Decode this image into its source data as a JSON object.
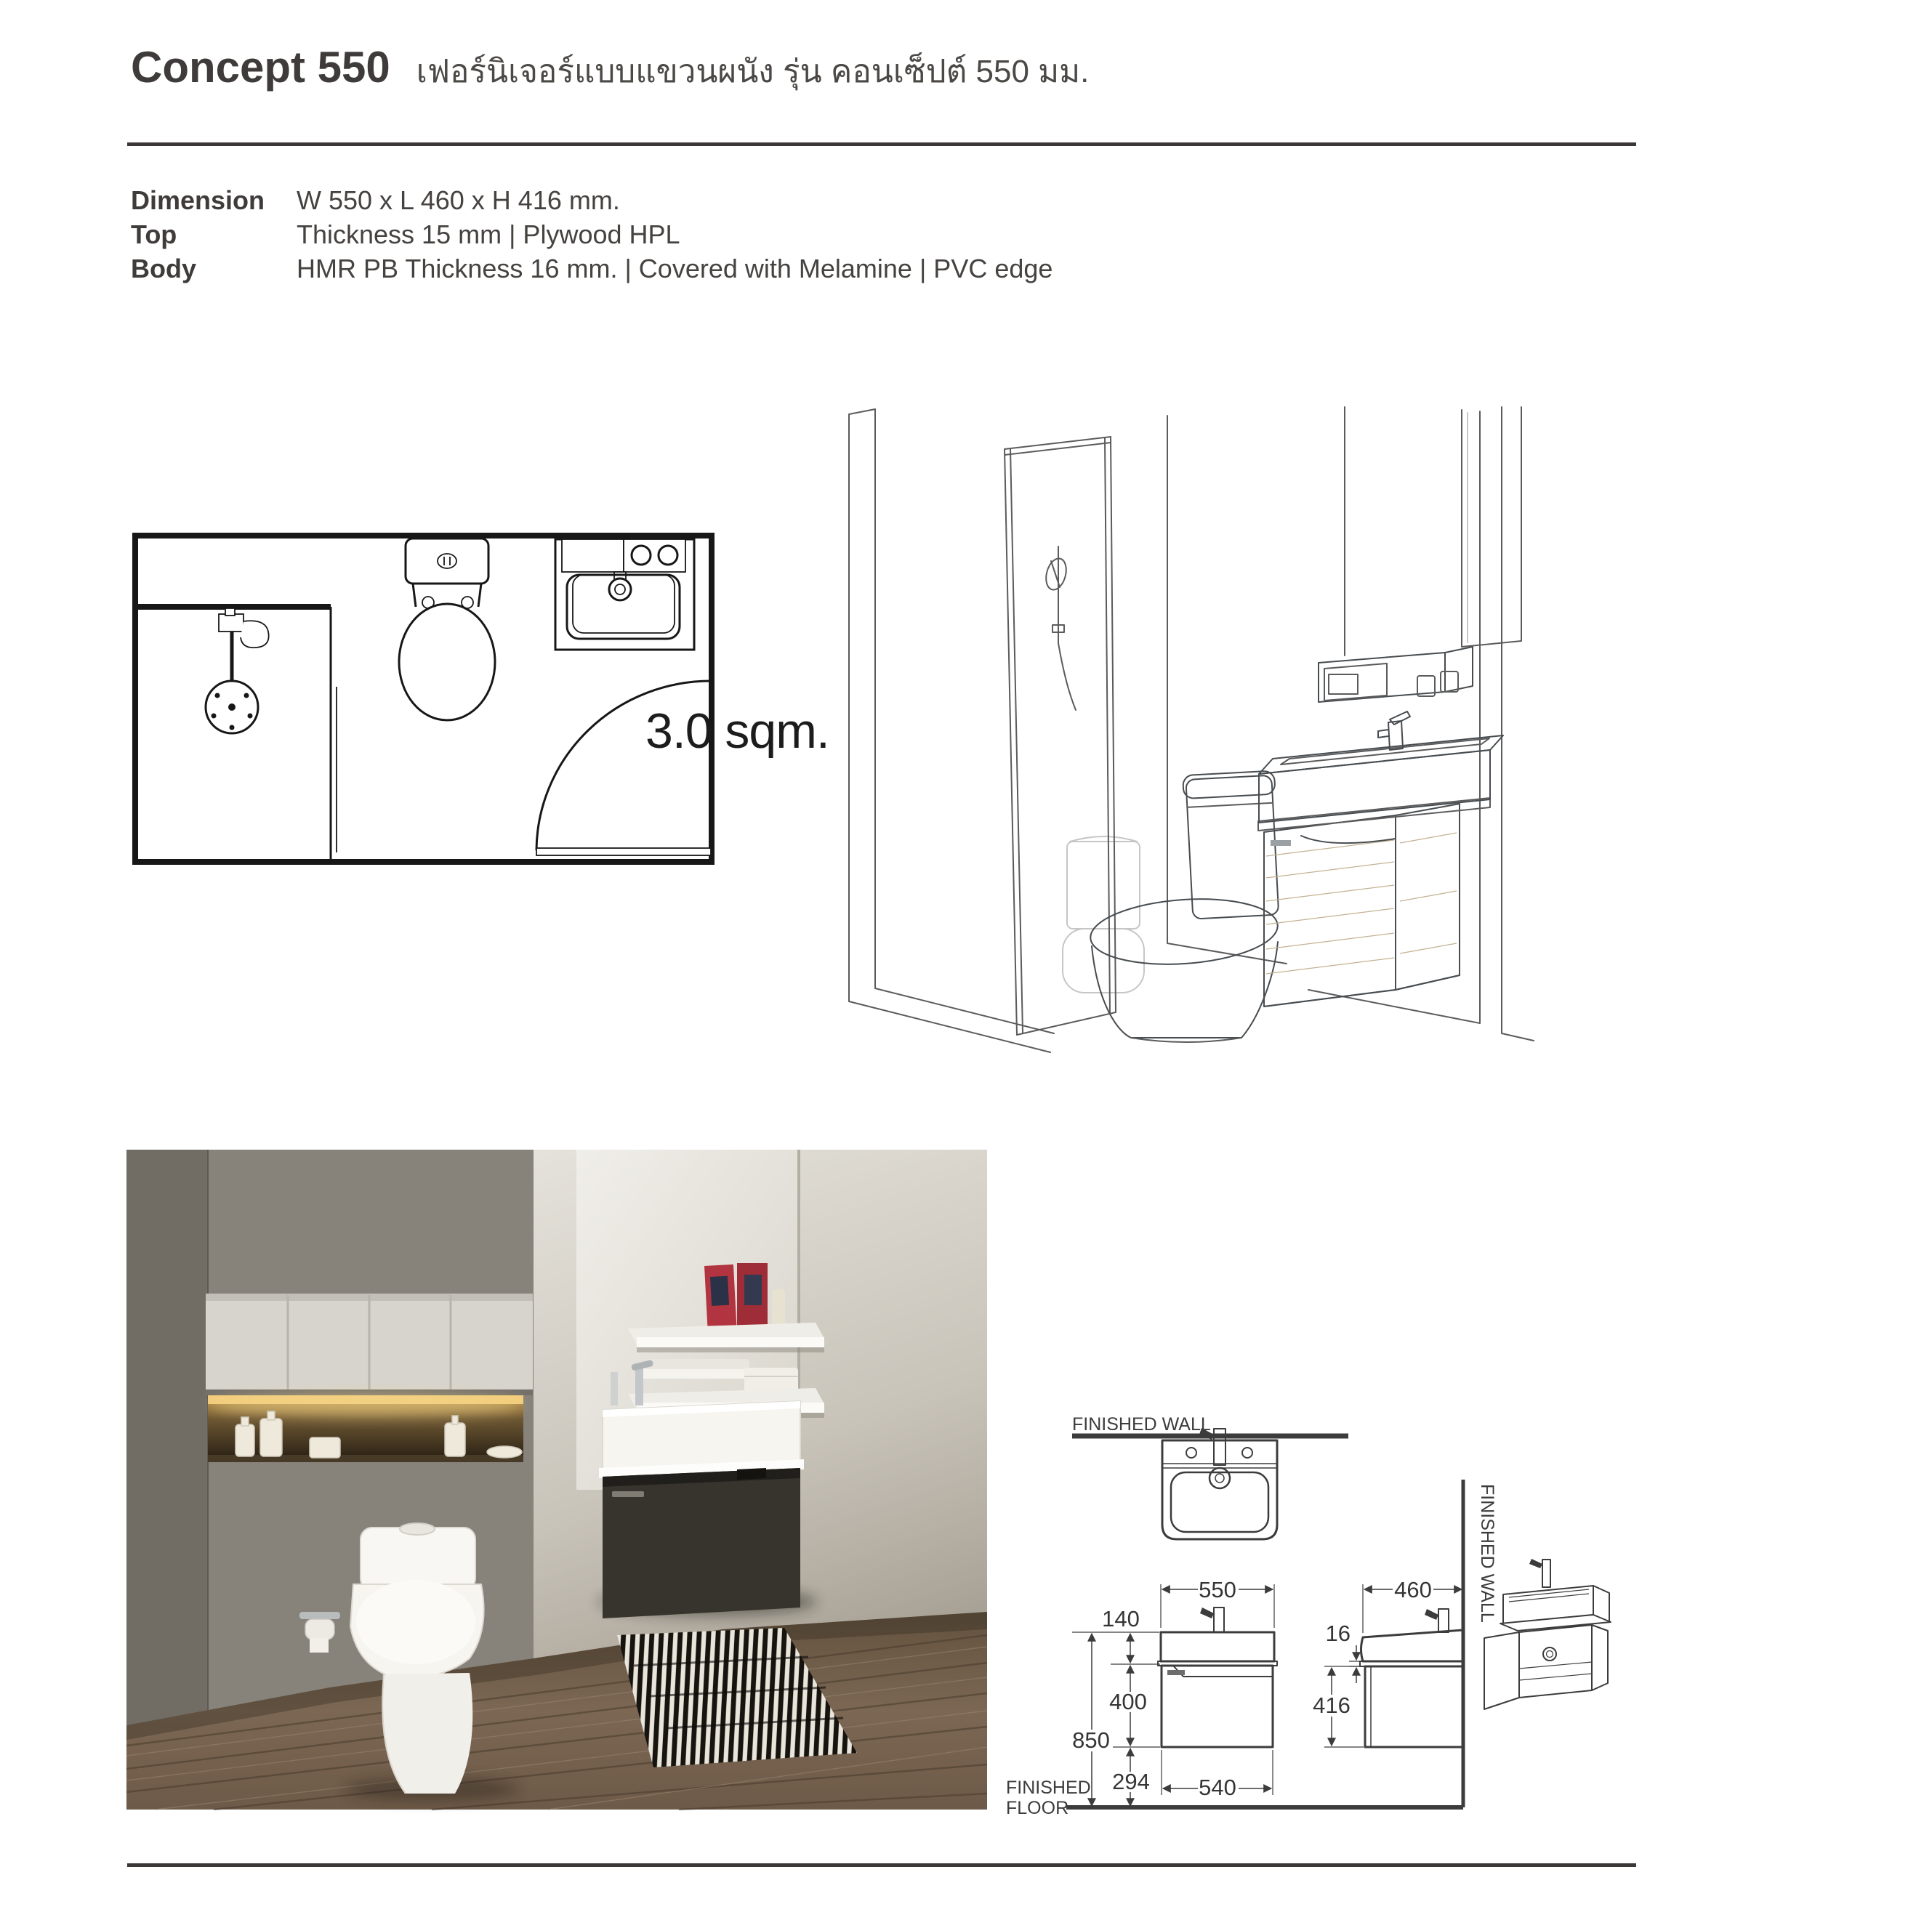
{
  "page": {
    "title": "Concept 550",
    "subtitle_thai": "เฟอร์นิเจอร์แบบแขวนผนัง รุ่น คอนเซ็ปต์ 550 มม.",
    "specs": {
      "dimension_label": "Dimension",
      "dimension_value": "W 550 x L 460 x H 416 mm.",
      "top_label": "Top",
      "top_value": "Thickness 15 mm | Plywood HPL",
      "body_label": "Body",
      "body_value": "HMR PB Thickness 16 mm. | Covered with Melamine | PVC edge"
    },
    "floor_plan": {
      "area_label": "3.0 sqm."
    },
    "dimensions": {
      "front_width_top": "550",
      "front_basin_height": "140",
      "front_total_height": "850",
      "front_cabinet_height": "400",
      "front_width_bottom": "540",
      "front_floor_clearance": "294",
      "side_depth": "460",
      "side_top_thickness": "16",
      "side_cabinet_height": "416",
      "finished_wall_top": "FINISHED WALL",
      "finished_wall_side": "FINISHED WALL",
      "finished_floor_line1": "FINISHED",
      "finished_floor_line2": "FLOOR"
    },
    "colors": {
      "rule": "#3b3737",
      "ink": "#3f3b3a",
      "drawing_line": "#3c3c3c",
      "sketch_wood": "#d8cbb0",
      "photo_cabinet_dark": "#38352f",
      "photo_niche_glow": "#f0c469",
      "photo_wood_floor": "#7d6a59"
    }
  }
}
